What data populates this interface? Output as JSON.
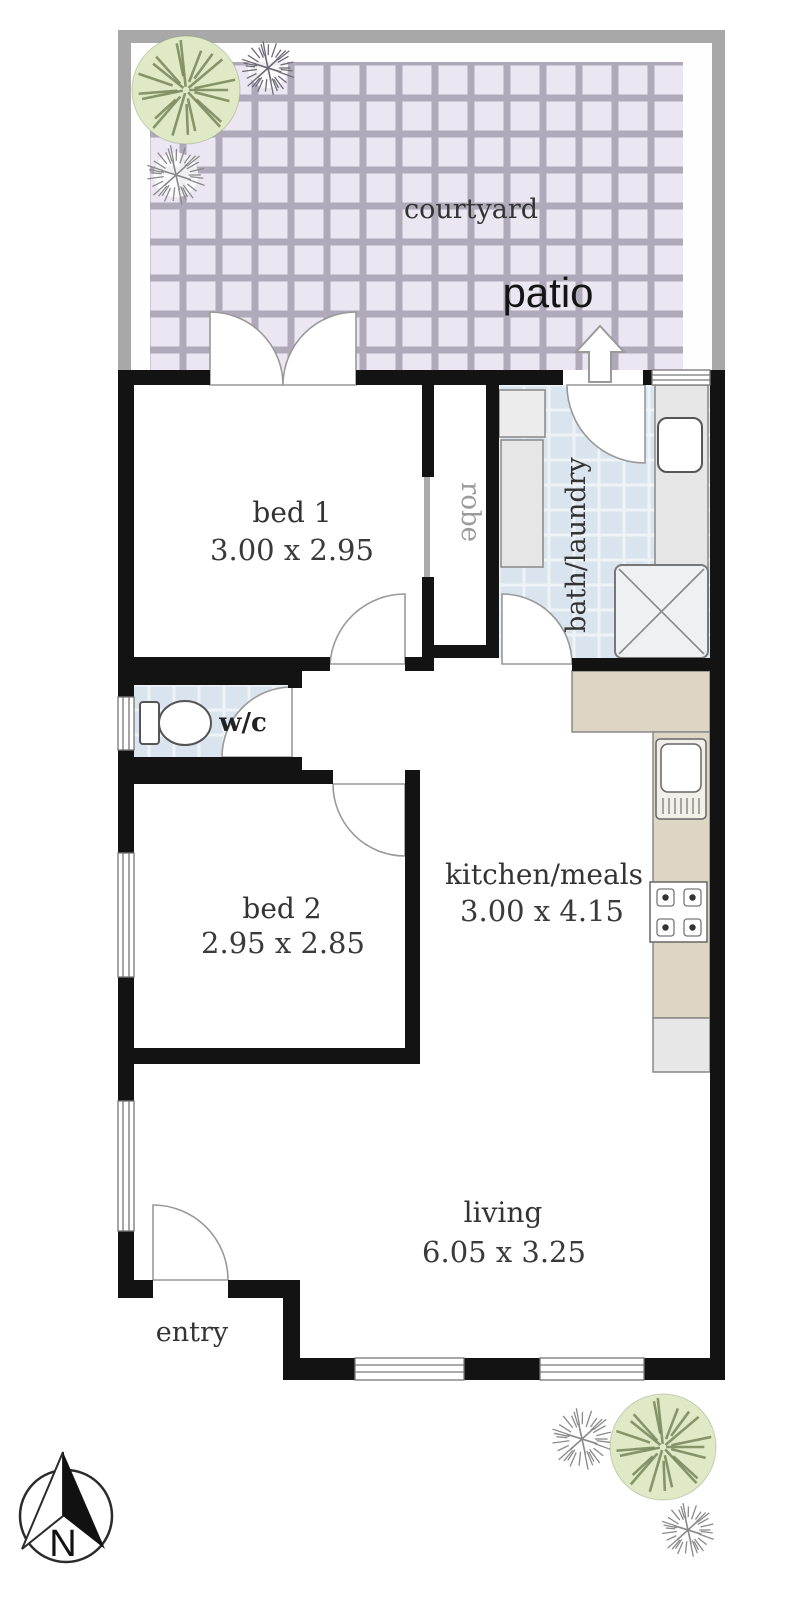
{
  "plan": {
    "title": "apartment floor plan",
    "rooms": {
      "courtyard": {
        "label": "courtyard"
      },
      "patio": {
        "label": "patio"
      },
      "bed1": {
        "label": "bed 1",
        "dims": "3.00 x 2.95"
      },
      "robe": {
        "label": "robe"
      },
      "bath": {
        "label": "bath/laundry"
      },
      "wc": {
        "label": "w/c"
      },
      "bed2": {
        "label": "bed 2",
        "dims": "2.95 x 2.85"
      },
      "kitchen": {
        "label": "kitchen/meals",
        "dims": "3.00 x 4.15"
      },
      "living": {
        "label": "living",
        "dims": "6.05 x 3.25"
      },
      "entry": {
        "label": "entry"
      }
    },
    "compass": {
      "north_label": "N"
    },
    "icons": [
      "tree-icon",
      "shrub-icon",
      "compass-icon",
      "patio-arrow-icon",
      "toilet-icon",
      "shower-icon",
      "laundry-tub-icon",
      "kitchen-sink-icon",
      "cooktop-icon"
    ],
    "colors": {
      "wall": "#131313",
      "outerWall": "#a8a8a8",
      "courtTile": "#ebe6f1",
      "courtGrout": "#b0a9ba",
      "wetTile": "#dae4ee",
      "wetGrout": "#eef3f7",
      "counter": "#ded6c5",
      "counterEdge": "#8a8a8a",
      "bench": "#e6e6e6",
      "appliance": "#e7e7e7",
      "treeFill": "#e0e9c5",
      "treeStroke": "#76865a",
      "shrubStroke": "#8a8a8a",
      "shrubDark": "#6f6a76",
      "doorStroke": "#999999",
      "fixtureStroke": "#666666",
      "textDark": "#333333",
      "textDim": "#3a3a3a",
      "textMuted": "#9b9b9b",
      "patioText": "#151515"
    }
  }
}
